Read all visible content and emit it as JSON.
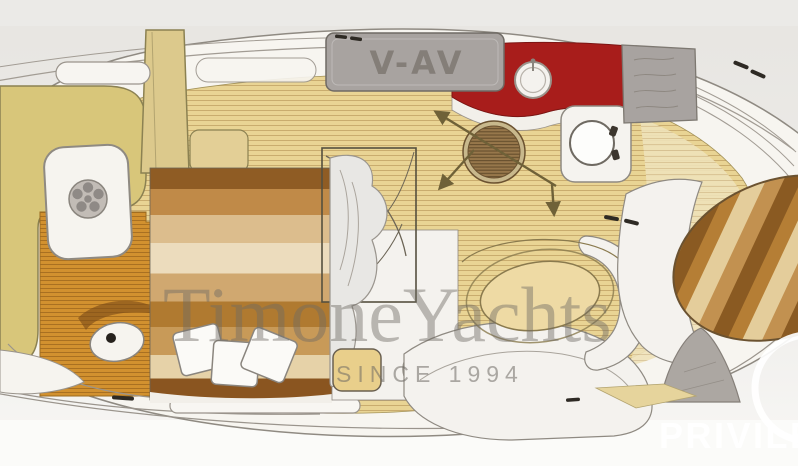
{
  "scene": {
    "type": "yacht-interior-floorplan",
    "orientation": "bow-right, stern-left, top-down view"
  },
  "watermark": {
    "brand": "TimoneYachts",
    "tagline": "SINCE 1994",
    "color": "#6e6a64"
  },
  "footer_brand": {
    "text": "PRIVILE",
    "color": "#ffffff"
  },
  "markings": {
    "hatch_label": "V-AV"
  },
  "palette": {
    "background": "#e9e7e3",
    "deck_white": "#f7f5f0",
    "floor_plank": "#e9d494",
    "cockpit_teak": "#d2912f",
    "seat_olive": "#d8c67a",
    "galley_red": "#a81d1b",
    "cabinet_gray": "#a8a3a0",
    "aft_cabin_brown": "#bf8a47",
    "table_wood_dark": "#8a5a22",
    "table_wood_light": "#e4cd9b",
    "berth_tan": "#eedaa4",
    "arrow_olive": "#6f6138",
    "outline": "#8f8a82"
  },
  "zones": {
    "cockpit": "aft cockpit with olive bench seating, teak floor and shower pad",
    "aft_cabin": "aft cabin berth with three pillows",
    "head": "head compartment with toilet, shower curtain and vanity stool",
    "galley": "red galley counter with round sink, stove and appliance",
    "salon": "salon with companionway hatch and direction arrows",
    "mid_cabin": "mid cabin oval berth with wrap-around settee",
    "bow_dinette": "bow dinette with round striped wood table"
  }
}
